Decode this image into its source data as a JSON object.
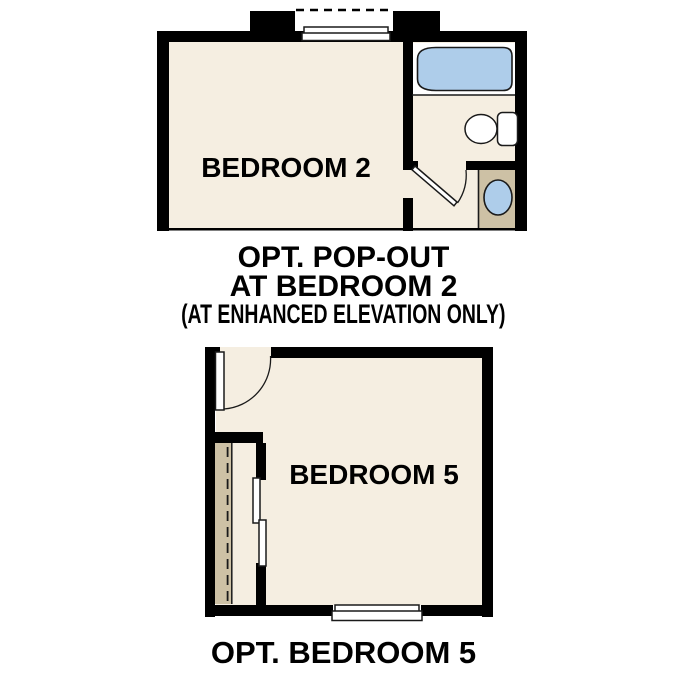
{
  "colors": {
    "background": "#ffffff",
    "wall": "#000000",
    "floor": "#f5eee1",
    "counter": "#cdc1a5",
    "water": "#aecdea",
    "fixture": "#ffffff",
    "line": "#1a1a1a",
    "text": "#000000"
  },
  "plan_top": {
    "room_label": "BEDROOM 2",
    "caption": {
      "line1": "OPT. POP-OUT",
      "line2": "AT BEDROOM 2",
      "line3": "(AT ENHANCED ELEVATION ONLY)"
    },
    "fixtures": [
      "pop-out-window",
      "bathtub",
      "toilet",
      "vanity-sink",
      "door-swing"
    ]
  },
  "plan_bottom": {
    "room_label": "BEDROOM 5",
    "caption": "OPT. BEDROOM 5",
    "fixtures": [
      "door-swing",
      "closet-rod",
      "sliding-closet-doors",
      "window"
    ]
  }
}
